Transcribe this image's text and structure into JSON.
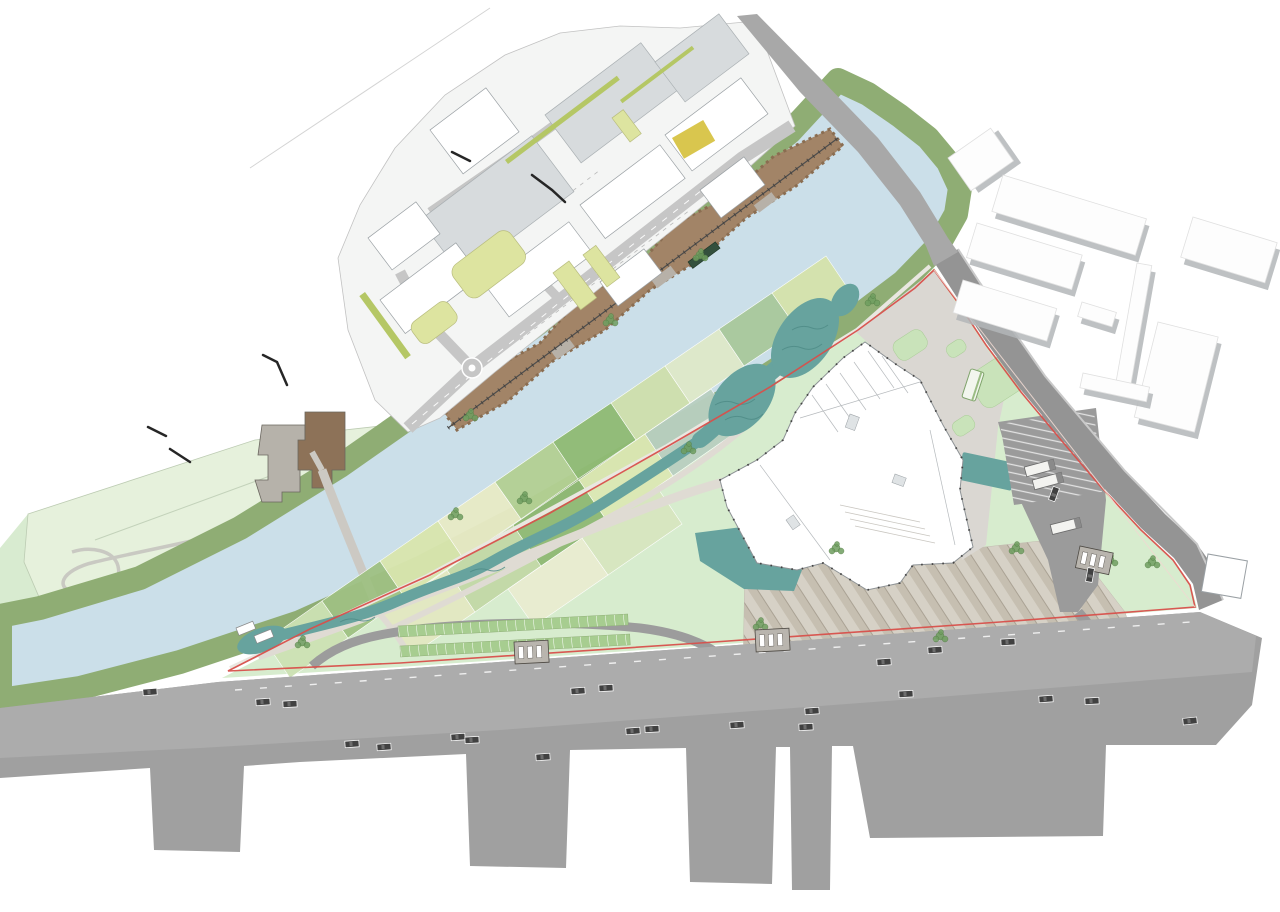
{
  "plan": {
    "kind": "landscape-masterplan-site-plan",
    "palette": {
      "paper": "#ffffff",
      "river": "#cbdfe9",
      "bank": "#8fad74",
      "northBand": "#d8ebd0",
      "fieldsArea": "#e6f1dc",
      "parkBase": "#d7ecce",
      "wet": "#67a39e",
      "wetDark": "#4f8c87",
      "path": "#dfdbd3",
      "bankPath": "#e9e7e1",
      "forecourt": "#dad7d2",
      "lawnPatch": "#c9e3ba",
      "roadGray": "#a8a8a8",
      "eastRoad": "#949494",
      "massGray": "#a0a0a0",
      "bandGray": "#acacac",
      "campusBase": "#f4f5f4",
      "campusRoad": "#c6c6c6",
      "slab": "#d7dbdd",
      "whiteBldg": "#ffffff",
      "bldgStroke": "#9aa0a4",
      "shadow": "#b3b6b8",
      "yellowGreen": "#dde4a0",
      "hedge": "#b5c765",
      "mustard": "#d9c64e",
      "darkBlock": "#919191",
      "parking": "#9b9b9b",
      "boundaryRed": "#d8504b",
      "car": "#414141",
      "bus": "#f3f3f0",
      "kiosk": "#b9b5ae",
      "treeBrown": "#a28467",
      "treeBrownDark": "#8a6d51",
      "treeGray": "#b7b1a8",
      "treeGreen": "#6f9e60",
      "stepBrown": "#8d7258",
      "stepGray": "#b6b2aa",
      "rail": "#4c4c4c"
    },
    "features": {
      "fields": [
        {
          "pts": "265,641 322,601 348,638 290,678",
          "fill": "#cde2b4"
        },
        {
          "pts": "322,601 380,561 405,598 348,638",
          "fill": "#9fc183"
        },
        {
          "pts": "380,561 438,521 463,558 405,598",
          "fill": "#d9e6ae"
        },
        {
          "pts": "438,521 495,482 521,519 463,558",
          "fill": "#e8ebc6"
        },
        {
          "pts": "495,482 553,442 578,479 521,519",
          "fill": "#b3d093"
        },
        {
          "pts": "553,442 611,403 636,440 578,479",
          "fill": "#8fbb74"
        },
        {
          "pts": "611,403 665,366 690,403 636,440",
          "fill": "#cfe0ac"
        },
        {
          "pts": "665,366 719,329 744,366 690,403",
          "fill": "#dfe9c9"
        },
        {
          "pts": "719,329 772,293 798,330 744,366",
          "fill": "#a9c89c"
        },
        {
          "pts": "772,293 826,256 851,293 798,330",
          "fill": "#d5e3ab"
        },
        {
          "pts": "381,616 447,570 475,612 409,657",
          "fill": "#e3e8c2"
        },
        {
          "pts": "447,570 513,525 541,566 475,612",
          "fill": "#c2d8a6"
        },
        {
          "pts": "513,525 579,480 607,521 541,566",
          "fill": "#8fb974"
        },
        {
          "pts": "579,480 645,434 673,476 607,521",
          "fill": "#dce8b4"
        },
        {
          "pts": "645,434 711,389 739,430 673,476",
          "fill": "#b9cfc0"
        },
        {
          "pts": "508,589 582,538 608,575 534,626",
          "fill": "#e9ecd1"
        },
        {
          "pts": "582,538 657,487 682,524 608,575",
          "fill": "#d8e6c0"
        }
      ],
      "cars": [
        [
          150,
          692,
          -4
        ],
        [
          263,
          702,
          -4
        ],
        [
          290,
          704,
          -3
        ],
        [
          352,
          744,
          -4
        ],
        [
          384,
          747,
          -4
        ],
        [
          458,
          737,
          -4
        ],
        [
          472,
          740,
          -3
        ],
        [
          543,
          757,
          -4
        ],
        [
          578,
          691,
          -4
        ],
        [
          606,
          688,
          -3
        ],
        [
          633,
          731,
          -4
        ],
        [
          652,
          729,
          -3
        ],
        [
          737,
          725,
          -4
        ],
        [
          806,
          727,
          -3
        ],
        [
          812,
          711,
          -4
        ],
        [
          884,
          662,
          -4
        ],
        [
          906,
          694,
          -3
        ],
        [
          935,
          650,
          -4
        ],
        [
          1008,
          642,
          -3
        ],
        [
          1046,
          699,
          -4
        ],
        [
          1092,
          701,
          -3
        ],
        [
          1190,
          721,
          -6
        ],
        [
          1054,
          494,
          -70
        ],
        [
          1090,
          575,
          -80
        ]
      ],
      "buses": [
        [
          1040,
          468,
          -15
        ],
        [
          1048,
          481,
          -15
        ],
        [
          1066,
          526,
          -14
        ]
      ],
      "shelters": [
        [
          973,
          385,
          -72
        ]
      ],
      "kiosks": [
        [
          514,
          642,
          -3
        ],
        [
          755,
          630,
          -3
        ],
        [
          1080,
          546,
          12
        ]
      ],
      "decks": [
        [
          236,
          628,
          -22
        ],
        [
          254,
          636,
          -22
        ]
      ],
      "trees": [
        [
          688,
          448
        ],
        [
          836,
          548
        ],
        [
          1016,
          548
        ],
        [
          1152,
          562
        ],
        [
          455,
          514
        ],
        [
          760,
          624
        ],
        [
          302,
          642
        ],
        [
          524,
          498
        ],
        [
          940,
          636
        ],
        [
          1110,
          560
        ],
        [
          872,
          300
        ],
        [
          610,
          320
        ],
        [
          470,
          415
        ],
        [
          700,
          255
        ]
      ],
      "ticks": [
        "148,427 166,436",
        "170,449 190,462",
        "263,355 277,362 287,385",
        "532,175 552,190 565,202",
        "452,152 470,161"
      ],
      "right_buildings": [
        [
          948,
          158,
          52,
          40,
          -35
        ],
        [
          1003,
          175,
          150,
          38,
          17
        ],
        [
          977,
          223,
          110,
          36,
          17
        ],
        [
          963,
          280,
          98,
          34,
          17
        ],
        [
          1137,
          263,
          15,
          125,
          10
        ],
        [
          1082,
          302,
          36,
          15,
          17
        ],
        [
          1158,
          322,
          62,
          98,
          14
        ],
        [
          1193,
          217,
          88,
          42,
          17
        ],
        [
          1083,
          373,
          68,
          15,
          12
        ]
      ]
    }
  }
}
